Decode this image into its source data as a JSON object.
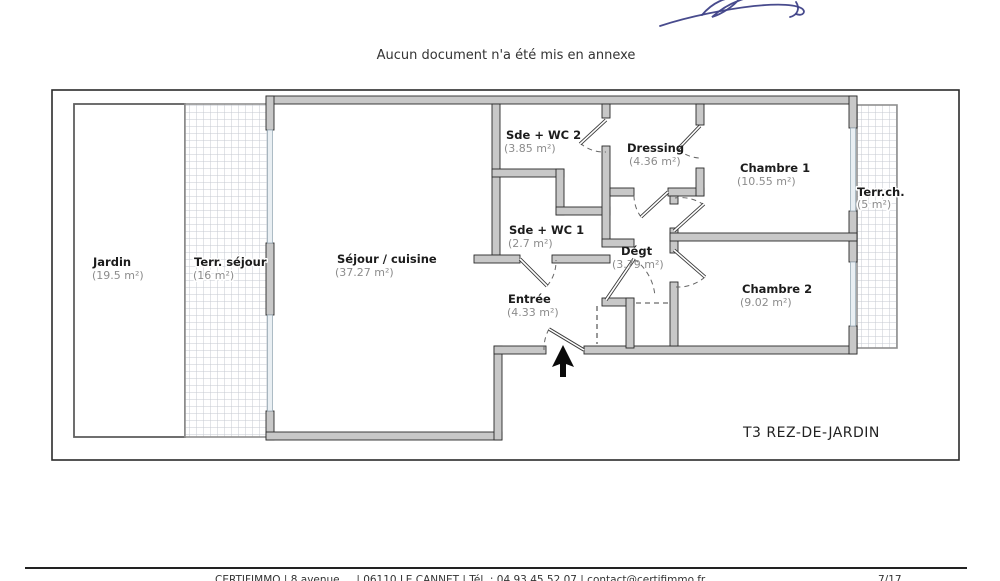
{
  "document": {
    "annex_note": "Aucun document n'a été mis en annexe",
    "plan_type_label": "T3 REZ-DE-JARDIN",
    "footer_info": "CERTIFIMMO | 8 avenue ... | 06110 LE CANNET | Tél. : 04 93 45 52 07 | contact@certifimmo.fr",
    "footer_page": "7/17"
  },
  "plan": {
    "rooms": [
      {
        "name": "Jardin",
        "area": "(19.5 m²)"
      },
      {
        "name": "Terr. séjour",
        "area": "(16 m²)"
      },
      {
        "name": "Séjour / cuisine",
        "area": "(37.27 m²)"
      },
      {
        "name": "Sde + WC 2",
        "area": "(3.85 m²)"
      },
      {
        "name": "Dressing",
        "area": "(4.36 m²)"
      },
      {
        "name": "Chambre 1",
        "area": "(10.55 m²)"
      },
      {
        "name": "Terr.ch.",
        "area": "(5 m²)"
      },
      {
        "name": "Sde + WC 1",
        "area": "(2.7 m²)"
      },
      {
        "name": "Dégt",
        "area": "(3.79 m²)"
      },
      {
        "name": "Entrée",
        "area": "(4.33 m²)"
      },
      {
        "name": "Chambre 2",
        "area": "(9.02 m²)"
      }
    ]
  },
  "colors": {
    "wall_fill": "#c8c8c8",
    "wall_stroke": "#2a2a2a",
    "window_fill": "#e9eff3",
    "hatch_line": "#c5cad0",
    "room_name_text": "#1c1c1c",
    "room_area_text": "#8c8c8c",
    "signature_ink": "#3e4187"
  }
}
